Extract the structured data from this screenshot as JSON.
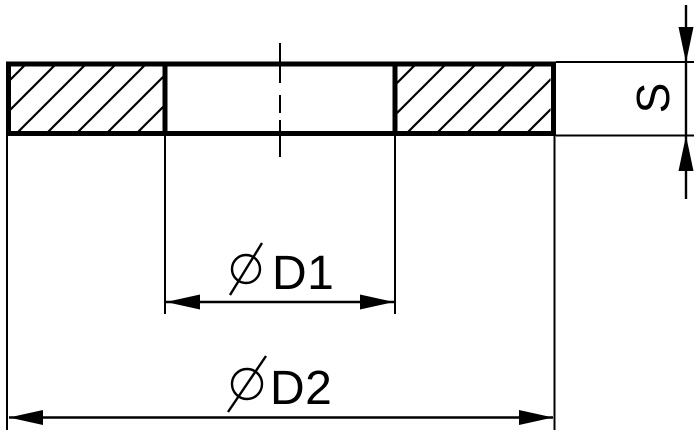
{
  "drawing": {
    "kind": "washer-cross-section",
    "labels": {
      "inner_diameter": "D1",
      "outer_diameter": "D2",
      "thickness": "S"
    },
    "symbols": {
      "diameter": "⌀"
    },
    "colors": {
      "line": "#000000",
      "background": "#ffffff"
    }
  }
}
